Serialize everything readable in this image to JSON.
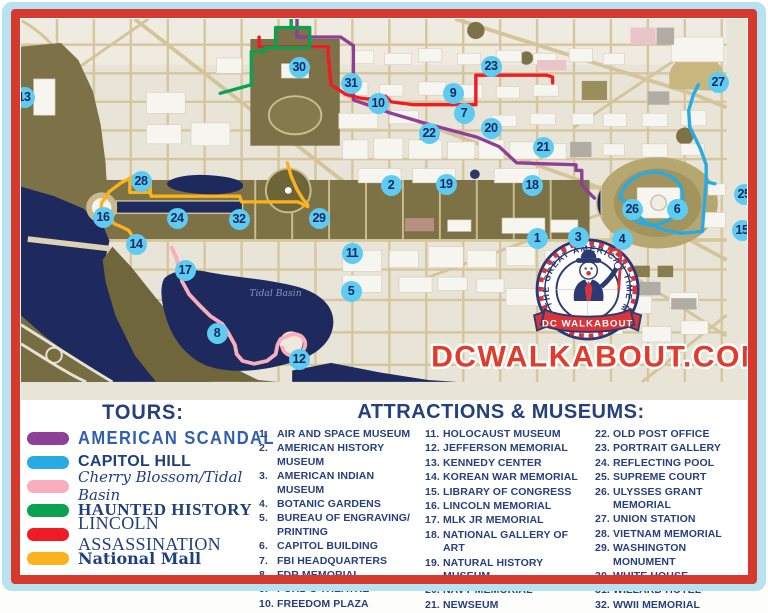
{
  "frame": {
    "outer_color": "#b7e2f0",
    "inner_color": "#d63a2e"
  },
  "map": {
    "website_text": "DCWALKABOUT.COM",
    "tidal_basin_label": "Tidal Basin",
    "badge": {
      "ring_text": "THE GREAT AMERICAN TIME MACHINE",
      "banner_text": "DC WALKABOUT"
    },
    "marker_style": {
      "bg": "#5ecbf2",
      "text": "#17295c"
    },
    "markers": [
      {
        "n": "1",
        "x": 537,
        "y": 238
      },
      {
        "n": "2",
        "x": 391,
        "y": 185
      },
      {
        "n": "3",
        "x": 578,
        "y": 237
      },
      {
        "n": "4",
        "x": 622,
        "y": 239
      },
      {
        "n": "5",
        "x": 351,
        "y": 291
      },
      {
        "n": "6",
        "x": 677,
        "y": 209
      },
      {
        "n": "7",
        "x": 464,
        "y": 113
      },
      {
        "n": "8",
        "x": 217,
        "y": 333
      },
      {
        "n": "9",
        "x": 453,
        "y": 93
      },
      {
        "n": "10",
        "x": 378,
        "y": 103
      },
      {
        "n": "11",
        "x": 352,
        "y": 253
      },
      {
        "n": "12",
        "x": 299,
        "y": 359
      },
      {
        "n": "13",
        "x": 24,
        "y": 97
      },
      {
        "n": "14",
        "x": 136,
        "y": 244
      },
      {
        "n": "15",
        "x": 742,
        "y": 230
      },
      {
        "n": "16",
        "x": 103,
        "y": 217
      },
      {
        "n": "17",
        "x": 185,
        "y": 270
      },
      {
        "n": "18",
        "x": 532,
        "y": 185
      },
      {
        "n": "19",
        "x": 446,
        "y": 184
      },
      {
        "n": "20",
        "x": 491,
        "y": 128
      },
      {
        "n": "21",
        "x": 543,
        "y": 147
      },
      {
        "n": "22",
        "x": 429,
        "y": 133
      },
      {
        "n": "23",
        "x": 491,
        "y": 66
      },
      {
        "n": "24",
        "x": 177,
        "y": 218
      },
      {
        "n": "25",
        "x": 744,
        "y": 194
      },
      {
        "n": "26",
        "x": 632,
        "y": 209
      },
      {
        "n": "27",
        "x": 718,
        "y": 82
      },
      {
        "n": "28",
        "x": 141,
        "y": 181
      },
      {
        "n": "29",
        "x": 319,
        "y": 218
      },
      {
        "n": "30",
        "x": 299,
        "y": 67
      },
      {
        "n": "31",
        "x": 351,
        "y": 83
      },
      {
        "n": "32",
        "x": 239,
        "y": 219
      }
    ]
  },
  "legend": {
    "tours": {
      "heading": "TOURS:",
      "items": [
        {
          "label": "AMERICAN SCANDAL",
          "color": "#8e3f98"
        },
        {
          "label": "CAPITOL HILL",
          "color": "#28abe2"
        },
        {
          "label": "Cherry Blossom/Tidal Basin",
          "color": "#f9aebe"
        },
        {
          "label": "HAUNTED HISTORY",
          "color": "#0aa14f"
        },
        {
          "label": "LINCOLN ASSASSINATION",
          "color": "#ee1c25"
        },
        {
          "label": "National Mall",
          "color": "#fcb21e"
        }
      ]
    },
    "attractions": {
      "heading": "ATTRACTIONS & MUSEUMS:",
      "items": [
        "AIR AND SPACE MUSEUM",
        "AMERICAN HISTORY MUSEUM",
        "AMERICAN INDIAN MUSEUM",
        "BOTANIC GARDENS",
        "BUREAU OF ENGRAVING/ PRINTING",
        "CAPITOL BUILDING",
        "FBI HEADQUARTERS",
        "FDR MEMORIAL",
        "FORD'S THEATRE",
        "FREEDOM PLAZA",
        "HOLOCAUST MUSEUM",
        "JEFFERSON MEMORIAL",
        "KENNEDY CENTER",
        "KOREAN WAR MEMORIAL",
        "LIBRARY OF CONGRESS",
        "LINCOLN MEMORIAL",
        "MLK JR MEMORIAL",
        "NATIONAL GALLERY OF ART",
        "NATURAL HISTORY MUSEUM",
        "NAVY MEMORIAL",
        "NEWSEUM",
        "OLD POST OFFICE",
        "PORTRAIT GALLERY",
        "REFLECTING POOL",
        "SUPREME COURT",
        "ULYSSES GRANT MEMORIAL",
        "UNION STATION",
        "VIETNAM MEMORIAL",
        "WASHINGTON MONUMENT",
        "WHITE HOUSE",
        "WILLARD HOTEL",
        "WWII MEMORIAL"
      ]
    }
  }
}
